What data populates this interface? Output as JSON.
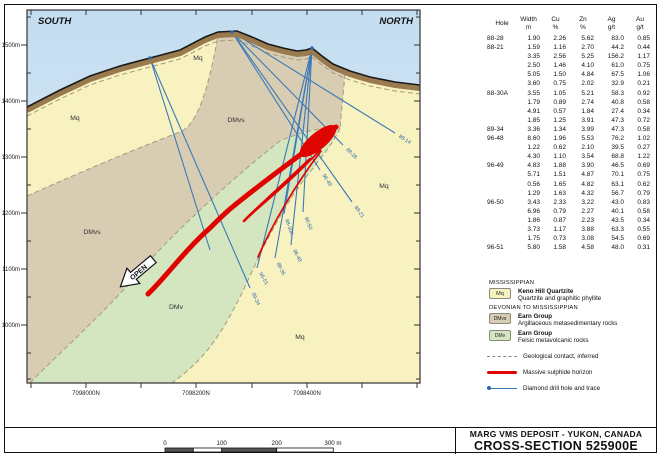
{
  "header": {
    "south": "SOUTH",
    "north": "NORTH"
  },
  "axes": {
    "elevation_ticks": [
      {
        "label": "1500m",
        "y": 45
      },
      {
        "label": "1400m",
        "y": 101
      },
      {
        "label": "1300m",
        "y": 157
      },
      {
        "label": "1200m",
        "y": 213
      },
      {
        "label": "1100m",
        "y": 269
      },
      {
        "label": "1000m",
        "y": 325
      }
    ],
    "minor_y": [
      17,
      73,
      129,
      185,
      241,
      297,
      353,
      379
    ],
    "northing_ticks": [
      {
        "label": "7098000N",
        "x": 86
      },
      {
        "label": "7098200N",
        "x": 196
      },
      {
        "label": "7098400N",
        "x": 307
      }
    ],
    "x_ticks": [
      31,
      86,
      141,
      196,
      252,
      307,
      362,
      417
    ]
  },
  "map": {
    "open_label": "OPEN",
    "unit_labels": [
      {
        "text": "Mq",
        "x": 75,
        "y": 120
      },
      {
        "text": "DMvs",
        "x": 92,
        "y": 234
      },
      {
        "text": "Mq",
        "x": 198,
        "y": 60
      },
      {
        "text": "DMvs",
        "x": 236,
        "y": 122
      },
      {
        "text": "Mq",
        "x": 384,
        "y": 188
      },
      {
        "text": "DMv",
        "x": 176,
        "y": 309
      },
      {
        "text": "Mq",
        "x": 300,
        "y": 339
      }
    ]
  },
  "drill_holes": [
    {
      "id": "88-14",
      "collar": [
        232,
        32
      ],
      "end": [
        395,
        133
      ],
      "angle": 32
    },
    {
      "id": "88-28",
      "collar": [
        232,
        32
      ],
      "end": [
        343,
        145
      ],
      "angle": 45
    },
    {
      "id": "96-49",
      "collar": [
        232,
        32
      ],
      "end": [
        320,
        170
      ],
      "angle": 57
    },
    {
      "id": "88-21",
      "collar": [
        232,
        32
      ],
      "end": [
        352,
        202
      ],
      "angle": 55
    },
    {
      "id": "96-50",
      "collar": [
        312,
        48
      ],
      "end": [
        303,
        212
      ],
      "angle": 68
    },
    {
      "id": "88-30A",
      "collar": [
        312,
        48
      ],
      "end": [
        284,
        214
      ],
      "angle": 72
    },
    {
      "id": "96-48",
      "collar": [
        312,
        48
      ],
      "end": [
        291,
        245
      ],
      "angle": 62
    },
    {
      "id": "89-35",
      "collar": [
        312,
        48
      ],
      "end": [
        275,
        258
      ],
      "angle": 64
    },
    {
      "id": "96-51",
      "collar": [
        312,
        48
      ],
      "end": [
        257,
        268
      ],
      "angle": 60
    },
    {
      "id": "89-34",
      "collar": [
        150,
        58
      ],
      "end": [
        250,
        288
      ],
      "angle": 65
    },
    {
      "id": "",
      "collar": [
        150,
        58
      ],
      "end": [
        210,
        250
      ],
      "angle": 0
    }
  ],
  "collars": [
    [
      232,
      32
    ],
    [
      312,
      48
    ],
    [
      150,
      58
    ]
  ],
  "table": {
    "headers": {
      "hole": "Hole",
      "width": "Width",
      "width_u": "m",
      "cu": "Cu",
      "cu_u": "%",
      "zn": "Zn",
      "zn_u": "%",
      "ag": "Ag",
      "ag_u": "g/t",
      "au": "Au",
      "au_u": "g/t"
    },
    "rows": [
      {
        "hole": "88-28",
        "width": "1.90",
        "cu": "2.26",
        "zn": "5.62",
        "ag": "83.0",
        "au": "0.85"
      },
      {
        "hole": "88-21",
        "width": "1.59",
        "cu": "1.16",
        "zn": "2.70",
        "ag": "44.2",
        "au": "0.44"
      },
      {
        "hole": "",
        "width": "3.35",
        "cu": "2.56",
        "zn": "5.25",
        "ag": "156.2",
        "au": "1.17"
      },
      {
        "hole": "",
        "width": "2.50",
        "cu": "1.46",
        "zn": "4.10",
        "ag": "61.0",
        "au": "0.75"
      },
      {
        "hole": "",
        "width": "5.05",
        "cu": "1.50",
        "zn": "4.84",
        "ag": "67.5",
        "au": "1.06"
      },
      {
        "hole": "",
        "width": "3.60",
        "cu": "0.75",
        "zn": "2.02",
        "ag": "32.9",
        "au": "0.21"
      },
      {
        "hole": "88-30A",
        "width": "3.55",
        "cu": "1.05",
        "zn": "5.21",
        "ag": "58.3",
        "au": "0.92"
      },
      {
        "hole": "",
        "width": "1.79",
        "cu": "0.89",
        "zn": "2.74",
        "ag": "40.8",
        "au": "0.58"
      },
      {
        "hole": "",
        "width": "4.91",
        "cu": "0.57",
        "zn": "1.84",
        "ag": "27.4",
        "au": "0.34"
      },
      {
        "hole": "",
        "width": "1.85",
        "cu": "1.25",
        "zn": "3.91",
        "ag": "47.3",
        "au": "0.72"
      },
      {
        "hole": "89-34",
        "width": "3.36",
        "cu": "1.34",
        "zn": "3.99",
        "ag": "47.3",
        "au": "0.58"
      },
      {
        "hole": "96-48",
        "width": "8.60",
        "cu": "1.96",
        "zn": "5.53",
        "ag": "76.2",
        "au": "1.02"
      },
      {
        "hole": "",
        "width": "1.22",
        "cu": "0.62",
        "zn": "2.10",
        "ag": "39.5",
        "au": "0.27"
      },
      {
        "hole": "",
        "width": "4.30",
        "cu": "1.10",
        "zn": "3.54",
        "ag": "68.8",
        "au": "1.22"
      },
      {
        "hole": "96-49",
        "width": "4.83",
        "cu": "1.88",
        "zn": "3.90",
        "ag": "46.5",
        "au": "0.69"
      },
      {
        "hole": "",
        "width": "5.71",
        "cu": "1.51",
        "zn": "4.87",
        "ag": "70.1",
        "au": "0.75"
      },
      {
        "hole": "",
        "width": "0.56",
        "cu": "1.65",
        "zn": "4.82",
        "ag": "63.1",
        "au": "0.62"
      },
      {
        "hole": "",
        "width": "1.29",
        "cu": "1.63",
        "zn": "4.32",
        "ag": "56.7",
        "au": "0.79"
      },
      {
        "hole": "96-50",
        "width": "3.43",
        "cu": "2.33",
        "zn": "3.22",
        "ag": "43.0",
        "au": "0.83"
      },
      {
        "hole": "",
        "width": "6.96",
        "cu": "0.79",
        "zn": "2.27",
        "ag": "40.1",
        "au": "0.58"
      },
      {
        "hole": "",
        "width": "1.86",
        "cu": "0.87",
        "zn": "2.23",
        "ag": "43.5",
        "au": "0.34"
      },
      {
        "hole": "",
        "width": "3.73",
        "cu": "1.17",
        "zn": "3.88",
        "ag": "63.3",
        "au": "0.55"
      },
      {
        "hole": "",
        "width": "1.75",
        "cu": "0.73",
        "zn": "3.08",
        "ag": "54.5",
        "au": "0.69"
      },
      {
        "hole": "96-51",
        "width": "5.80",
        "cu": "1.58",
        "zn": "4.58",
        "ag": "48.0",
        "au": "0.31"
      }
    ]
  },
  "legend": {
    "sections": [
      {
        "era": "MISSISSIPPIAN",
        "units": [
          {
            "code": "Mq",
            "color": "#f8f2c0",
            "name": "Keno Hill Quartzite",
            "desc": "Quartzite and graphitic phyllite"
          }
        ]
      },
      {
        "era": "DEVONIAN TO MISSISSIPPIAN",
        "units": [
          {
            "code": "DMvs",
            "color": "#d8ccb2",
            "name": "Earn Group",
            "desc": "Argillaceous metasedimentary rocks"
          },
          {
            "code": "DMv",
            "color": "#d4e6c0",
            "name": "Earn Group",
            "desc": "Felsic metavolcanic rocks"
          }
        ]
      }
    ],
    "lines": [
      {
        "style": "dashed",
        "label": "Geological contact, inferred"
      },
      {
        "style": "sulphide",
        "label": "Massive sulphide horizon"
      },
      {
        "style": "drill",
        "label": "Diamond drill hole and trace"
      }
    ]
  },
  "scalebar": {
    "labels": [
      "0",
      "100",
      "200",
      "300 m"
    ]
  },
  "title_block": {
    "line1": "MARG VMS DEPOSIT - YUKON, CANADA",
    "line2": "CROSS-SECTION 525900E"
  },
  "colors": {
    "sky": "#cbe2f3",
    "quartzite": "#f8f2c0",
    "metased": "#d8ccb2",
    "metavolc": "#d4e6c0",
    "overburden": "#9a7b50",
    "contact_dash": "#a39a7e",
    "drill_blue": "#3a79b8",
    "sulphide_red": "#e00400",
    "frame": "#333333"
  },
  "chart_data": {
    "type": "table",
    "title": "Drill hole assay intersections",
    "columns": [
      "Hole",
      "Width m",
      "Cu %",
      "Zn %",
      "Ag g/t",
      "Au g/t"
    ],
    "note": "rows mirror table.rows above"
  }
}
